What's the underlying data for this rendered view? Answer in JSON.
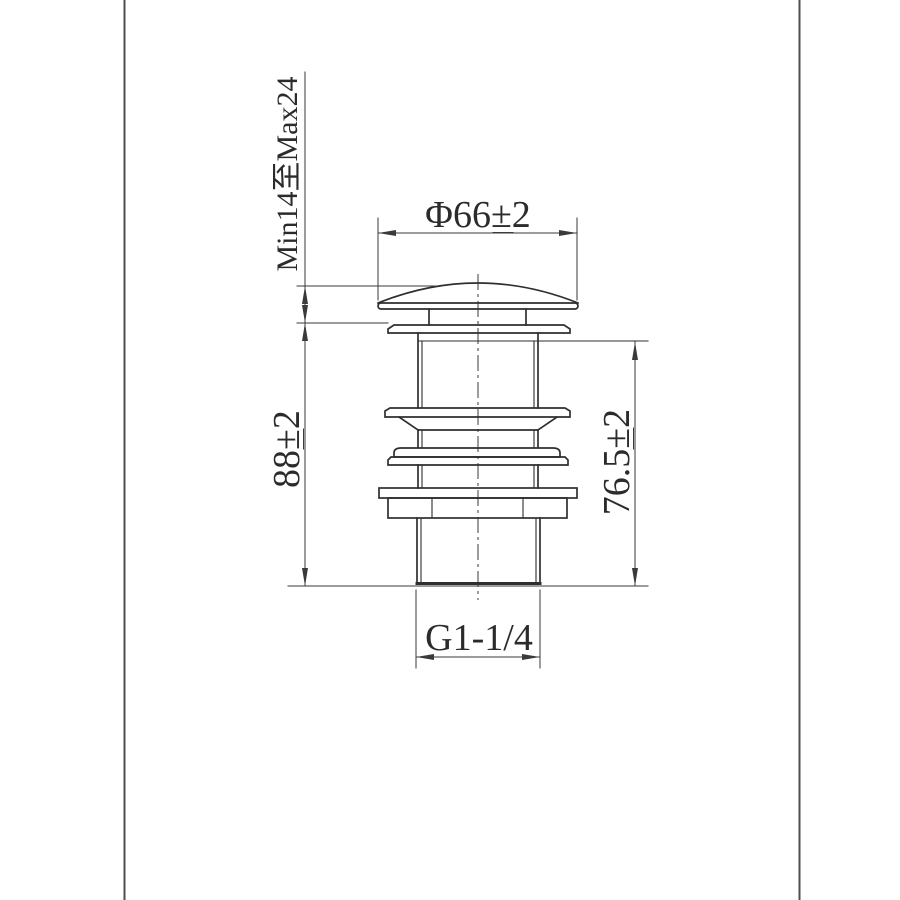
{
  "drawing": {
    "description": "pop-up basin waste technical drawing",
    "dimensions": {
      "cap_diameter": {
        "label": "Φ66±2"
      },
      "mount_range": {
        "label": "Min14至Max24"
      },
      "body_height": {
        "label": "88±2"
      },
      "shank_height": {
        "label": "76.5±2"
      },
      "thread_size": {
        "label": "G1-1/4"
      }
    },
    "colors": {
      "background": "#ffffff",
      "line": "#2f2f2f",
      "dim": "#3a3a3a",
      "text": "#2b2b2b",
      "frame": "#4d4d4d"
    }
  }
}
